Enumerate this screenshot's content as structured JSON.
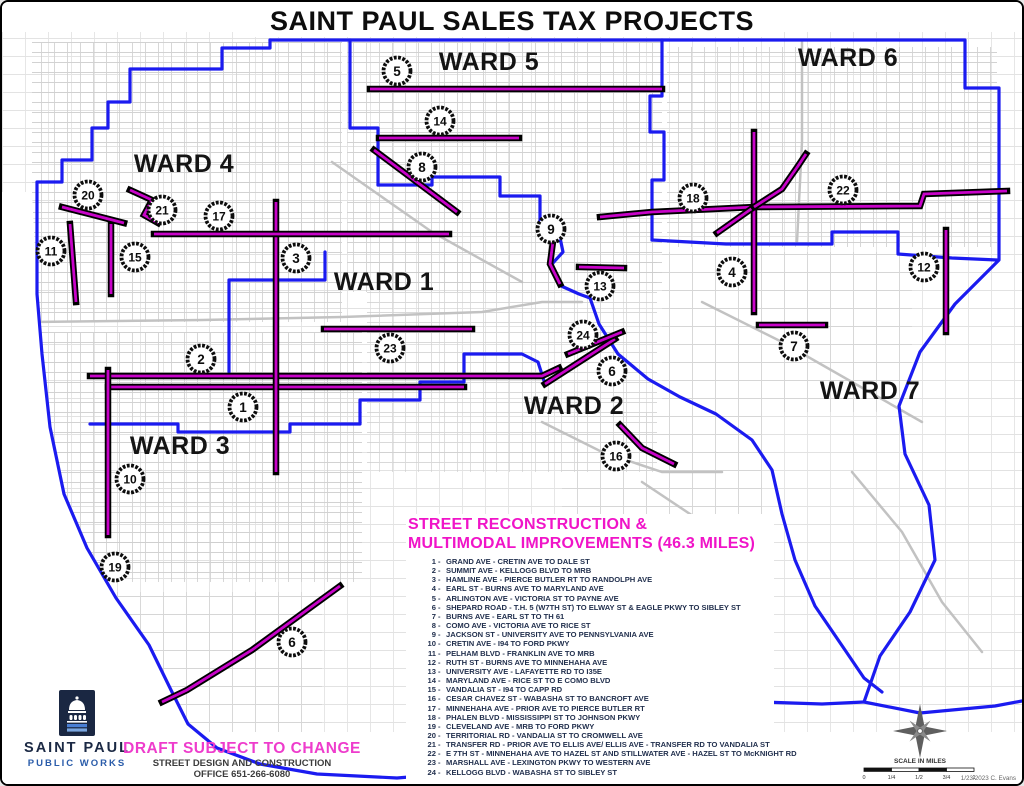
{
  "title": "SAINT PAUL SALES TAX PROJECTS",
  "colors": {
    "boundary": "#1b1bf0",
    "route": "#c803c8",
    "route_casing": "#000000",
    "street": "#cbcbcb",
    "legend_title": "#f014c8",
    "draft": "#ee3ccc",
    "navy": "#1b2944",
    "pwblue": "#2a5caa",
    "marker_ring": "#0d0d0d"
  },
  "map": {
    "wards": [
      {
        "label": "WARD 4",
        "x": 182,
        "y": 170
      },
      {
        "label": "WARD 5",
        "x": 487,
        "y": 68
      },
      {
        "label": "WARD 6",
        "x": 846,
        "y": 64
      },
      {
        "label": "WARD 1",
        "x": 382,
        "y": 288
      },
      {
        "label": "WARD 2",
        "x": 572,
        "y": 412
      },
      {
        "label": "WARD 3",
        "x": 178,
        "y": 452
      },
      {
        "label": "WARD 7",
        "x": 868,
        "y": 397
      }
    ],
    "markers": [
      {
        "n": "5",
        "x": 395,
        "y": 69
      },
      {
        "n": "14",
        "x": 438,
        "y": 119
      },
      {
        "n": "8",
        "x": 420,
        "y": 165
      },
      {
        "n": "20",
        "x": 86,
        "y": 193
      },
      {
        "n": "21",
        "x": 160,
        "y": 208
      },
      {
        "n": "17",
        "x": 217,
        "y": 214
      },
      {
        "n": "18",
        "x": 691,
        "y": 196
      },
      {
        "n": "22",
        "x": 841,
        "y": 188
      },
      {
        "n": "11",
        "x": 49,
        "y": 249
      },
      {
        "n": "15",
        "x": 133,
        "y": 255
      },
      {
        "n": "3",
        "x": 294,
        "y": 256
      },
      {
        "n": "9",
        "x": 549,
        "y": 227
      },
      {
        "n": "13",
        "x": 598,
        "y": 284
      },
      {
        "n": "4",
        "x": 730,
        "y": 270
      },
      {
        "n": "12",
        "x": 922,
        "y": 265
      },
      {
        "n": "24",
        "x": 581,
        "y": 333
      },
      {
        "n": "23",
        "x": 388,
        "y": 346
      },
      {
        "n": "7",
        "x": 792,
        "y": 344
      },
      {
        "n": "2",
        "x": 199,
        "y": 357
      },
      {
        "n": "6",
        "x": 610,
        "y": 369
      },
      {
        "n": "1",
        "x": 241,
        "y": 405
      },
      {
        "n": "16",
        "x": 614,
        "y": 454
      },
      {
        "n": "10",
        "x": 128,
        "y": 477
      },
      {
        "n": "19",
        "x": 113,
        "y": 565
      },
      {
        "n": "6",
        "x": 290,
        "y": 640
      }
    ],
    "boundaries": [
      [
        [
          268,
          38
        ],
        [
          963,
          38
        ],
        [
          963,
          86
        ],
        [
          997,
          86
        ],
        [
          997,
          258
        ],
        [
          953,
          302
        ],
        [
          918,
          350
        ],
        [
          897,
          404
        ],
        [
          903,
          452
        ],
        [
          927,
          503
        ],
        [
          933,
          558
        ],
        [
          908,
          610
        ],
        [
          878,
          654
        ],
        [
          862,
          700
        ],
        [
          918,
          711
        ],
        [
          993,
          704
        ],
        [
          1020,
          699
        ]
      ],
      [
        [
          268,
          38
        ],
        [
          268,
          46
        ],
        [
          220,
          46
        ],
        [
          220,
          67
        ],
        [
          128,
          67
        ],
        [
          128,
          100
        ],
        [
          106,
          100
        ],
        [
          106,
          126
        ],
        [
          90,
          126
        ],
        [
          90,
          158
        ],
        [
          60,
          158
        ],
        [
          60,
          180
        ],
        [
          35,
          180
        ],
        [
          35,
          292
        ],
        [
          40,
          352
        ],
        [
          48,
          425
        ],
        [
          62,
          492
        ],
        [
          85,
          546
        ],
        [
          114,
          596
        ],
        [
          147,
          643
        ],
        [
          169,
          688
        ],
        [
          186,
          722
        ],
        [
          215,
          746
        ],
        [
          258,
          762
        ],
        [
          315,
          772
        ],
        [
          395,
          776
        ],
        [
          468,
          770
        ],
        [
          524,
          757
        ],
        [
          574,
          735
        ],
        [
          612,
          712
        ],
        [
          642,
          699
        ],
        [
          700,
          694
        ],
        [
          760,
          700
        ],
        [
          820,
          702
        ],
        [
          862,
          700
        ]
      ],
      [
        [
          348,
          38
        ],
        [
          348,
          126
        ],
        [
          376,
          126
        ],
        [
          376,
          183
        ]
      ],
      [
        [
          376,
          183
        ],
        [
          430,
          183
        ],
        [
          430,
          175
        ],
        [
          498,
          175
        ],
        [
          498,
          194
        ],
        [
          538,
          194
        ],
        [
          538,
          226
        ],
        [
          556,
          226
        ],
        [
          561,
          250
        ],
        [
          549,
          263
        ],
        [
          557,
          283
        ],
        [
          577,
          292
        ],
        [
          588,
          296
        ]
      ],
      [
        [
          660,
          38
        ],
        [
          660,
          94
        ],
        [
          648,
          94
        ],
        [
          648,
          130
        ],
        [
          662,
          130
        ],
        [
          662,
          178
        ],
        [
          650,
          178
        ],
        [
          650,
          238
        ]
      ],
      [
        [
          650,
          238
        ],
        [
          724,
          242
        ],
        [
          830,
          242
        ],
        [
          830,
          230
        ],
        [
          896,
          230
        ],
        [
          896,
          252
        ],
        [
          950,
          256
        ],
        [
          995,
          258
        ]
      ],
      [
        [
          323,
          250
        ],
        [
          323,
          278
        ],
        [
          227,
          278
        ],
        [
          227,
          370
        ]
      ],
      [
        [
          88,
          422
        ],
        [
          176,
          422
        ],
        [
          176,
          430
        ],
        [
          288,
          430
        ],
        [
          288,
          422
        ],
        [
          358,
          422
        ],
        [
          358,
          398
        ],
        [
          418,
          398
        ],
        [
          418,
          380
        ],
        [
          448,
          380
        ]
      ],
      [
        [
          448,
          380
        ],
        [
          462,
          380
        ],
        [
          462,
          352
        ],
        [
          520,
          352
        ],
        [
          536,
          360
        ],
        [
          543,
          382
        ]
      ],
      [
        [
          588,
          296
        ],
        [
          597,
          322
        ],
        [
          616,
          352
        ],
        [
          646,
          377
        ],
        [
          678,
          395
        ],
        [
          714,
          412
        ],
        [
          750,
          438
        ],
        [
          770,
          468
        ],
        [
          780,
          512
        ],
        [
          793,
          558
        ],
        [
          813,
          604
        ],
        [
          843,
          648
        ],
        [
          862,
          676
        ],
        [
          880,
          690
        ]
      ]
    ],
    "routes": [
      {
        "id": "1",
        "points": [
          [
            106,
            385
          ],
          [
            462,
            385
          ]
        ]
      },
      {
        "id": "2",
        "points": [
          [
            88,
            374
          ],
          [
            540,
            374
          ],
          [
            557,
            366
          ]
        ]
      },
      {
        "id": "3",
        "points": [
          [
            274,
            200
          ],
          [
            274,
            470
          ]
        ]
      },
      {
        "id": "4",
        "points": [
          [
            752,
            130
          ],
          [
            752,
            310
          ]
        ]
      },
      {
        "id": "5",
        "points": [
          [
            368,
            87
          ],
          [
            660,
            87
          ]
        ]
      },
      {
        "id": "6a",
        "points": [
          [
            543,
            382
          ],
          [
            613,
            337
          ]
        ]
      },
      {
        "id": "6b",
        "points": [
          [
            338,
            584
          ],
          [
            250,
            648
          ],
          [
            185,
            688
          ],
          [
            160,
            700
          ]
        ]
      },
      {
        "id": "7",
        "points": [
          [
            757,
            323
          ],
          [
            823,
            323
          ]
        ]
      },
      {
        "id": "8",
        "points": [
          [
            372,
            148
          ],
          [
            455,
            210
          ]
        ]
      },
      {
        "id": "9",
        "points": [
          [
            552,
            232
          ],
          [
            548,
            262
          ],
          [
            558,
            282
          ]
        ]
      },
      {
        "id": "10",
        "points": [
          [
            106,
            368
          ],
          [
            106,
            533
          ]
        ]
      },
      {
        "id": "11",
        "points": [
          [
            68,
            222
          ],
          [
            74,
            300
          ]
        ]
      },
      {
        "id": "12",
        "points": [
          [
            944,
            228
          ],
          [
            944,
            330
          ]
        ]
      },
      {
        "id": "13",
        "points": [
          [
            577,
            265
          ],
          [
            622,
            266
          ]
        ]
      },
      {
        "id": "14",
        "points": [
          [
            377,
            136
          ],
          [
            517,
            136
          ]
        ]
      },
      {
        "id": "15",
        "points": [
          [
            109,
            222
          ],
          [
            109,
            292
          ]
        ]
      },
      {
        "id": "16",
        "points": [
          [
            618,
            423
          ],
          [
            640,
            446
          ],
          [
            672,
            462
          ]
        ]
      },
      {
        "id": "17",
        "points": [
          [
            152,
            232
          ],
          [
            447,
            232
          ]
        ]
      },
      {
        "id": "18",
        "points": [
          [
            598,
            215
          ],
          [
            650,
            210
          ],
          [
            752,
            205
          ]
        ]
      },
      {
        "id": "20",
        "points": [
          [
            60,
            205
          ],
          [
            95,
            214
          ],
          [
            122,
            221
          ]
        ]
      },
      {
        "id": "21",
        "points": [
          [
            128,
            188
          ],
          [
            150,
            198
          ],
          [
            142,
            213
          ],
          [
            156,
            221
          ]
        ]
      },
      {
        "id": "22",
        "points": [
          [
            715,
            231
          ],
          [
            752,
            205
          ],
          [
            918,
            204
          ],
          [
            922,
            192
          ],
          [
            1005,
            189
          ]
        ]
      },
      {
        "id": "22b",
        "points": [
          [
            752,
            205
          ],
          [
            780,
            187
          ],
          [
            796,
            164
          ],
          [
            804,
            152
          ]
        ]
      },
      {
        "id": "23",
        "points": [
          [
            322,
            327
          ],
          [
            470,
            327
          ]
        ]
      },
      {
        "id": "24",
        "points": [
          [
            566,
            352
          ],
          [
            620,
            330
          ]
        ]
      }
    ]
  },
  "legend": {
    "title_line1": "STREET RECONSTRUCTION &",
    "title_line2": "MULTIMODAL IMPROVEMENTS (46.3 MILES)",
    "items": [
      {
        "n": "1",
        "d": "GRAND AVE - CRETIN AVE TO DALE ST"
      },
      {
        "n": "2",
        "d": "SUMMIT AVE - KELLOGG BLVD TO MRB"
      },
      {
        "n": "3",
        "d": "HAMLINE AVE - PIERCE BUTLER RT TO RANDOLPH AVE"
      },
      {
        "n": "4",
        "d": "EARL ST - BURNS AVE TO MARYLAND AVE"
      },
      {
        "n": "5",
        "d": "ARLINGTON AVE - VICTORIA ST TO PAYNE AVE"
      },
      {
        "n": "6",
        "d": "SHEPARD ROAD - T.H. 5 (W7TH ST) TO ELWAY ST & EAGLE PKWY TO SIBLEY ST"
      },
      {
        "n": "7",
        "d": "BURNS AVE - EARL ST TO TH 61"
      },
      {
        "n": "8",
        "d": "COMO AVE - VICTORIA AVE TO RICE ST"
      },
      {
        "n": "9",
        "d": "JACKSON ST - UNIVERSITY AVE TO PENNSYLVANIA AVE"
      },
      {
        "n": "10",
        "d": "CRETIN AVE - I94 TO FORD PKWY"
      },
      {
        "n": "11",
        "d": "PELHAM BLVD - FRANKLIN AVE TO MRB"
      },
      {
        "n": "12",
        "d": "RUTH ST - BURNS AVE TO MINNEHAHA AVE"
      },
      {
        "n": "13",
        "d": "UNIVERSITY AVE - LAFAYETTE RD TO I35E"
      },
      {
        "n": "14",
        "d": "MARYLAND AVE - RICE ST TO E COMO BLVD"
      },
      {
        "n": "15",
        "d": "VANDALIA ST - I94 TO CAPP RD"
      },
      {
        "n": "16",
        "d": "CESAR CHAVEZ ST - WABASHA ST TO BANCROFT AVE"
      },
      {
        "n": "17",
        "d": "MINNEHAHA AVE - PRIOR AVE TO PIERCE BUTLER RT"
      },
      {
        "n": "18",
        "d": "PHALEN BLVD - MISSISSIPPI ST TO JOHNSON PKWY"
      },
      {
        "n": "19",
        "d": "CLEVELAND AVE - MRB TO FORD PKWY"
      },
      {
        "n": "20",
        "d": "TERRITORIAL RD - VANDALIA ST TO CROMWELL AVE"
      },
      {
        "n": "21",
        "d": "TRANSFER RD - PRIOR AVE TO ELLIS AVE/ ELLIS AVE - TRANSFER RD TO VANDALIA ST"
      },
      {
        "n": "22",
        "d": "E 7TH ST - MINNEHAHA AVE TO HAZEL ST AND STILLWATER AVE - HAZEL ST TO McKNIGHT RD"
      },
      {
        "n": "23",
        "d": "MARSHALL AVE - LEXINGTON PKWY TO WESTERN AVE"
      },
      {
        "n": "24",
        "d": "KELLOGG BLVD - WABASHA ST TO SIBLEY ST"
      }
    ]
  },
  "footer": {
    "logo_title": "SAINT PAUL",
    "logo_subtitle": "PUBLIC WORKS",
    "draft": "DRAFT SUBJECT TO CHANGE",
    "office_line1": "STREET DESIGN AND CONSTRUCTION",
    "office_line2": "OFFICE 651-266-6080"
  },
  "scalebar": {
    "label": "SCALE IN MILES",
    "ticks": [
      "0",
      "1/4",
      "1/2",
      "3/4",
      "1"
    ],
    "credit": "1/23/2023 C. Evans"
  }
}
